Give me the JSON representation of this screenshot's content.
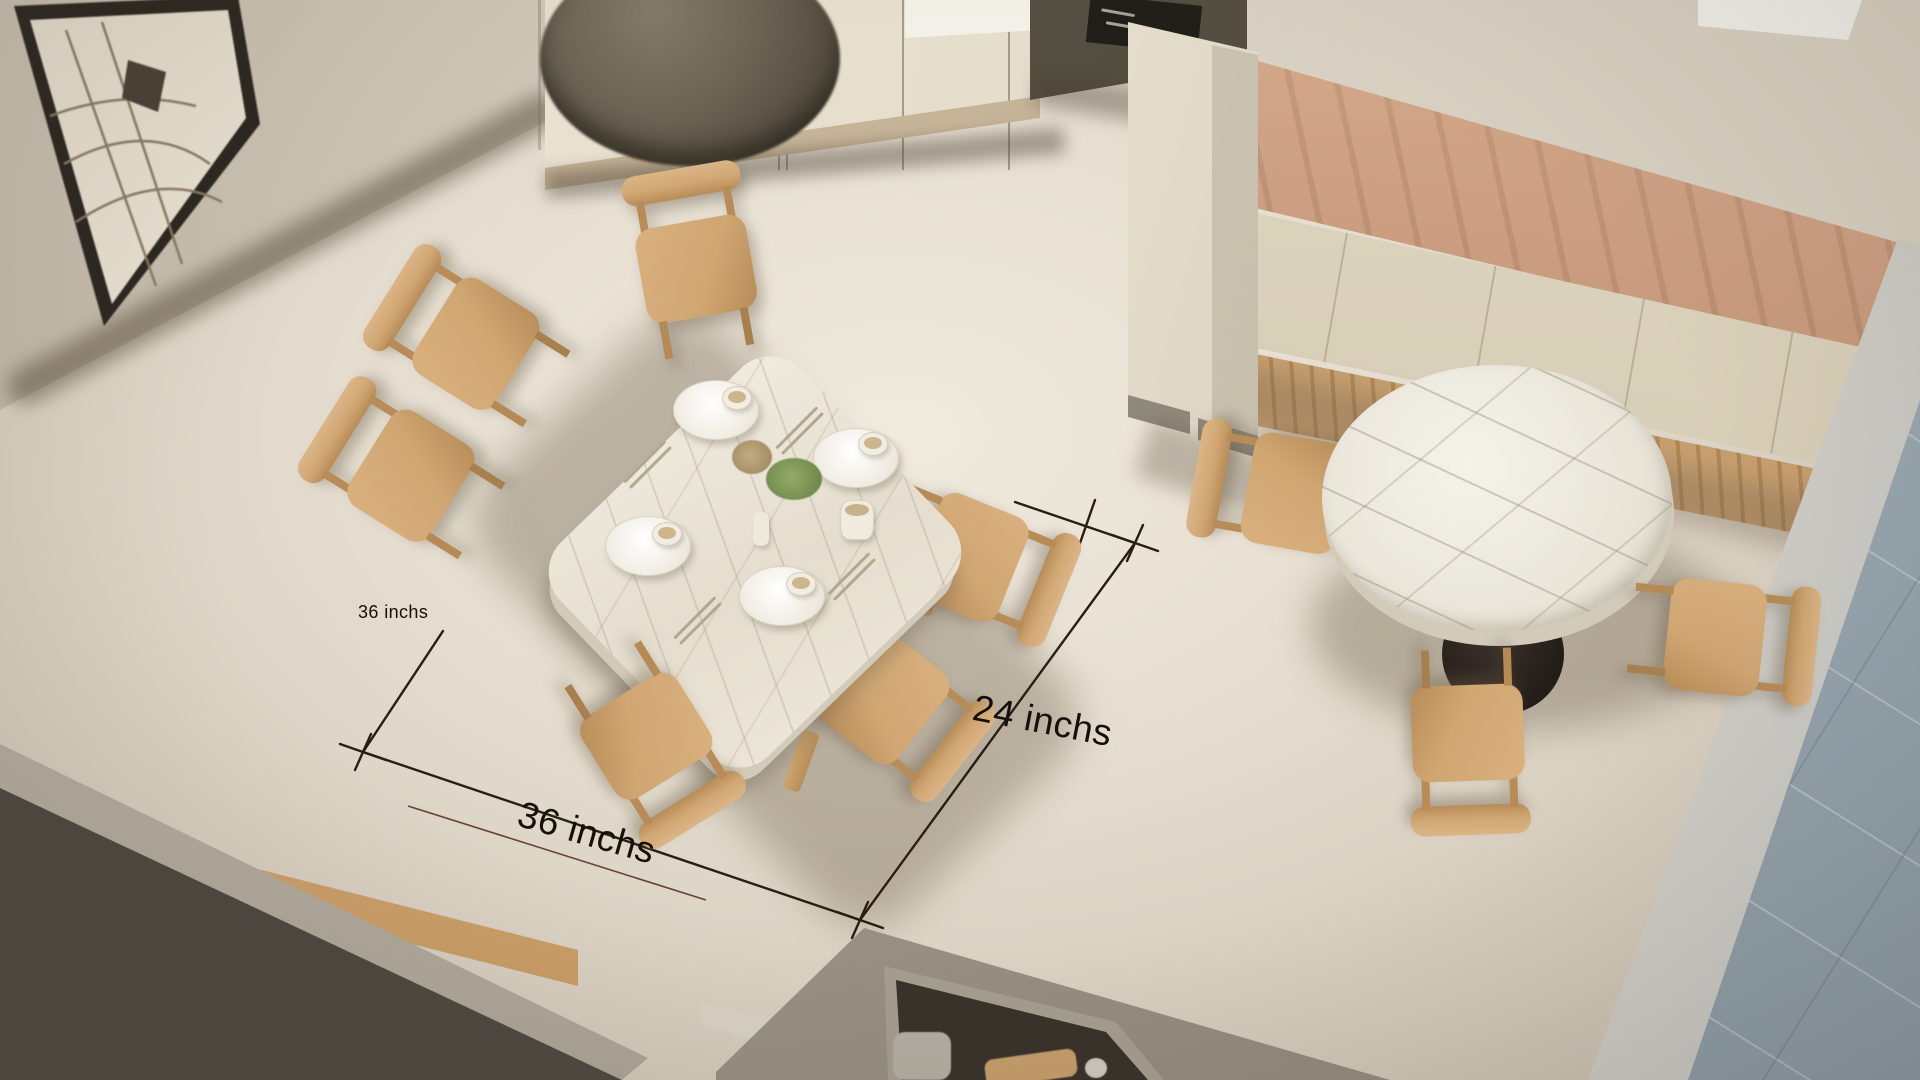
{
  "annotations": {
    "clearance_left_label": "36 inchs",
    "table_bottom_label": "36 inchs",
    "clearance_right_label": "24 inchs"
  },
  "scene_objects": [
    "rectangular-dining-table-6-chairs",
    "round-marble-pedestal-table-3-chairs",
    "banquette-bench",
    "kitchen-cabinets",
    "pendant-lamp",
    "framed-sketch",
    "gray-parapet-wall",
    "service-counter",
    "adjacent-room-tiled-floor"
  ],
  "palette": {
    "floor_light": "#f0eadf",
    "floor_dark": "#c4bbab",
    "wall_dark": "#b7ad9c",
    "wood": "#d0a673",
    "wood_dark": "#b78c58",
    "marble_edge": "#d3cbba",
    "banquette_leather": "#bd8260",
    "banquette_leather_dark": "#a76d4c",
    "cushion": "#e0d7c3",
    "gray_wall": "#6e685c",
    "gray_wall_top": "#b4ada0",
    "blue_floor": "#aebac2",
    "pedestal": "#241d17",
    "lamp": "#6b6254",
    "dim_line": "#2a1d12",
    "dim_line_accent": "#55281c",
    "label_color": "#16100a"
  }
}
